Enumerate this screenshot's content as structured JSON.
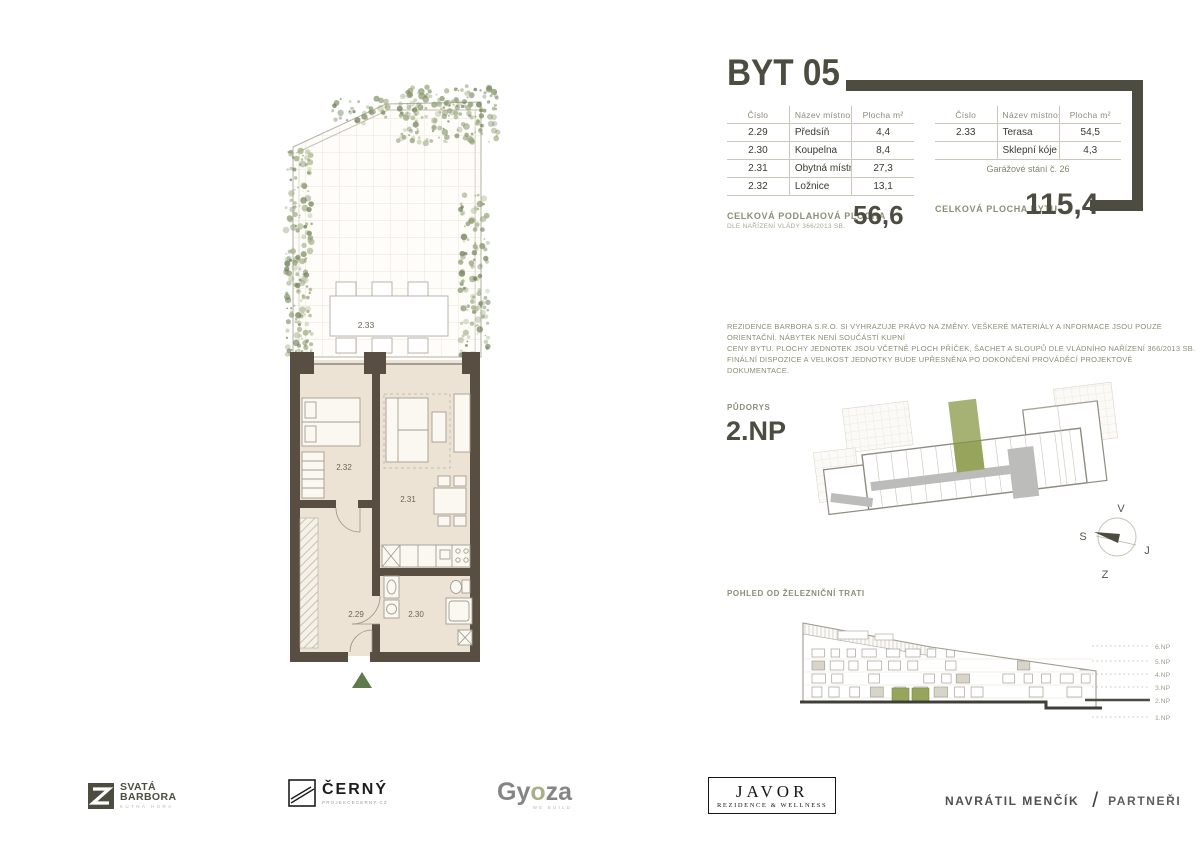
{
  "title": "BYT 05",
  "tables": {
    "left": {
      "headers": [
        "Číslo",
        "Název místnosti",
        "Plocha m²"
      ],
      "rows": [
        {
          "num": "2.29",
          "name": "Předsíň",
          "area": "4,4"
        },
        {
          "num": "2.30",
          "name": "Koupelna",
          "area": "8,4"
        },
        {
          "num": "2.31",
          "name": "Obytná místnost",
          "area": "27,3"
        },
        {
          "num": "2.32",
          "name": "Ložnice",
          "area": "13,1"
        }
      ]
    },
    "right": {
      "headers": [
        "Číslo",
        "Název místnosti",
        "Plocha m²"
      ],
      "rows": [
        {
          "num": "2.33",
          "name": "Terasa",
          "area": "54,5"
        },
        {
          "num": "",
          "name": "Sklepní kóje (h2)",
          "area": "4,3"
        }
      ],
      "note": "Garážové stání č. 26"
    }
  },
  "totals": {
    "floor_label": "CELKOVÁ PODLAHOVÁ PLOCHA",
    "floor_sublabel": "DLE NAŘÍZENÍ VLÁDY 366/2013 SB.",
    "floor_value": "56,6",
    "unit_label": "CELKOVÁ PLOCHA BYTU",
    "unit_value": "115,4"
  },
  "disclaimer": [
    "REZIDENCE BARBORA S.R.O. SI VYHRAZUJE PRÁVO NA ZMĚNY. VEŠKERÉ MATERIÁLY A INFORMACE JSOU POUZE ORIENTAČNÍ. NÁBYTEK NENÍ SOUČÁSTÍ KUPNÍ",
    "CENY BYTU. PLOCHY JEDNOTEK JSOU VČETNĚ PLOCH PŘÍČEK, ŠACHET A SLOUPŮ DLE VLÁDNÍHO NAŘÍZENÍ 366/2013 SB.",
    "FINÁLNÍ DISPOZICE A VELIKOST JEDNOTKY BUDE UPŘESNĚNA PO DOKONČENÍ PROVÁDĚCÍ PROJEKTOVÉ DOKUMENTACE."
  ],
  "plan_section": {
    "label": "PŮDORYS",
    "floor": "2.NP"
  },
  "rooms": {
    "terrace": "2.33",
    "bedroom": "2.32",
    "living": "2.31",
    "hall": "2.29",
    "bath": "2.30"
  },
  "compass": {
    "top": "V",
    "left": "S",
    "right": "J",
    "bottom": "Z"
  },
  "elevation_section": {
    "label": "POHLED OD ŽELEZNIČNÍ TRATI",
    "floors": [
      "6.NP",
      "5.NP",
      "4.NP",
      "3.NP",
      "2.NP",
      "1.NP"
    ],
    "highlight_floor": "2.NP"
  },
  "logos": {
    "svata": {
      "line1": "SVATÁ",
      "line2": "BARBORA",
      "sub": "KUTNÁ HORA"
    },
    "cerny": {
      "name": "ČERNÝ",
      "sub": "PROJEKCECERNY.CZ"
    },
    "gyoza": {
      "p1": "Gy",
      "p2": "o",
      "p3": "za",
      "sub": "WE BUILD"
    },
    "javor": {
      "line1": "JAVOR",
      "line2": "REZIDENCE & WELLNESS"
    },
    "navratil": {
      "left": "NAVRÁTIL MENČÍK",
      "slash": "/",
      "right": "PARTNEŘI"
    }
  },
  "colors": {
    "accent": "#4c4c41",
    "wall_brown": "#594e42",
    "floor_beige": "#ece3d5",
    "highlight_green": "#97a45b",
    "corridor_gray": "#bcbcba",
    "foliage_green": "#87976a"
  }
}
